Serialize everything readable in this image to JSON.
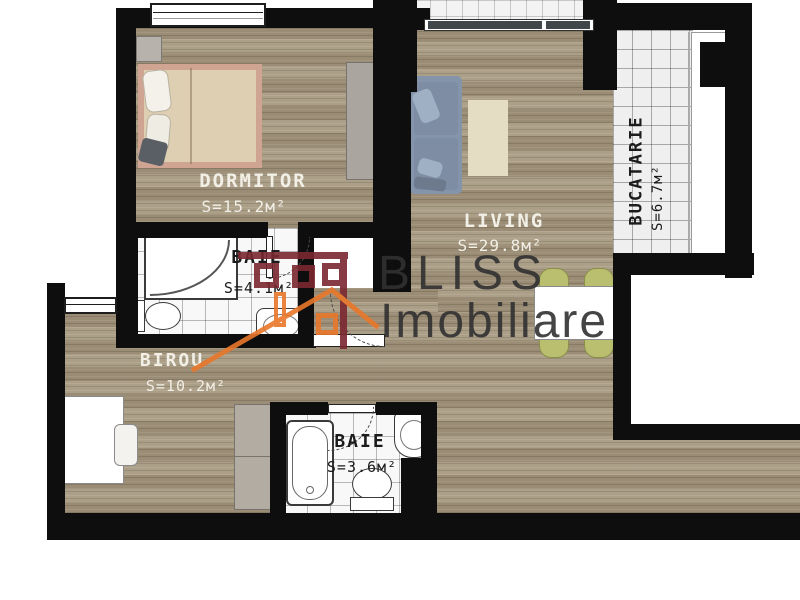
{
  "plan": {
    "title": "apartment-floor-plan",
    "rooms": [
      {
        "name": "DORMITOR",
        "area": "S=15.2м²"
      },
      {
        "name": "BAIE",
        "area": "S=4.1м²"
      },
      {
        "name": "LIVING",
        "area": "S=29.8м²"
      },
      {
        "name": "BUCATARIE",
        "area": "S=6.7м²"
      },
      {
        "name": "BIROU",
        "area": "S=10.2м²"
      },
      {
        "name": "BAIE",
        "area": "S=3.6м²"
      }
    ]
  },
  "watermark": {
    "brand_line1": "BLISS",
    "brand_line2": "Imobiliare"
  },
  "colors": {
    "wall": "#0e0e0e",
    "wood": "#a6987f",
    "tile": "#f8f8f8",
    "maroon": "#7b2831",
    "orange": "#e8772a",
    "sofa": "#8494aa",
    "chair": "#b9bf6e"
  }
}
